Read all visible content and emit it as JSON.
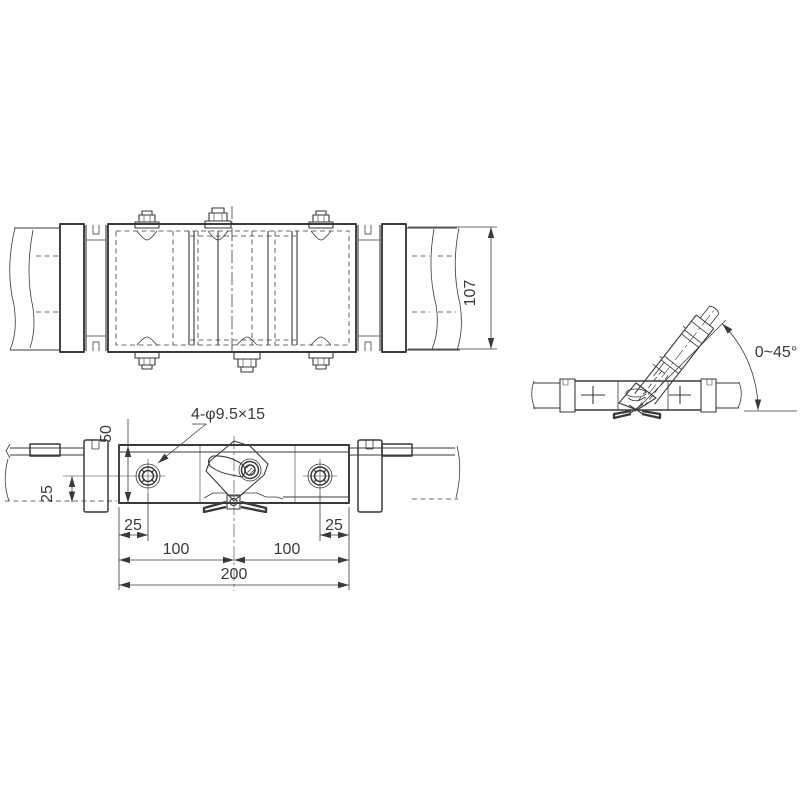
{
  "meta": {
    "type": "technical-drawing",
    "description": "Three-view drawing of pipe mounting clamp with swivel arm",
    "line_color": "#3a3a3a",
    "background_color": "#ffffff"
  },
  "views": {
    "top": {
      "dim_height": "107"
    },
    "front": {
      "callout_holes": "4-φ9.5×15",
      "dim_body_height": "50",
      "dim_hole_offset": "25",
      "dim_left_hole_inset": "25",
      "dim_right_hole_inset": "25",
      "dim_center_left": "100",
      "dim_center_right": "100",
      "dim_overall": "200"
    },
    "side": {
      "dim_angle": "0~45°"
    }
  }
}
